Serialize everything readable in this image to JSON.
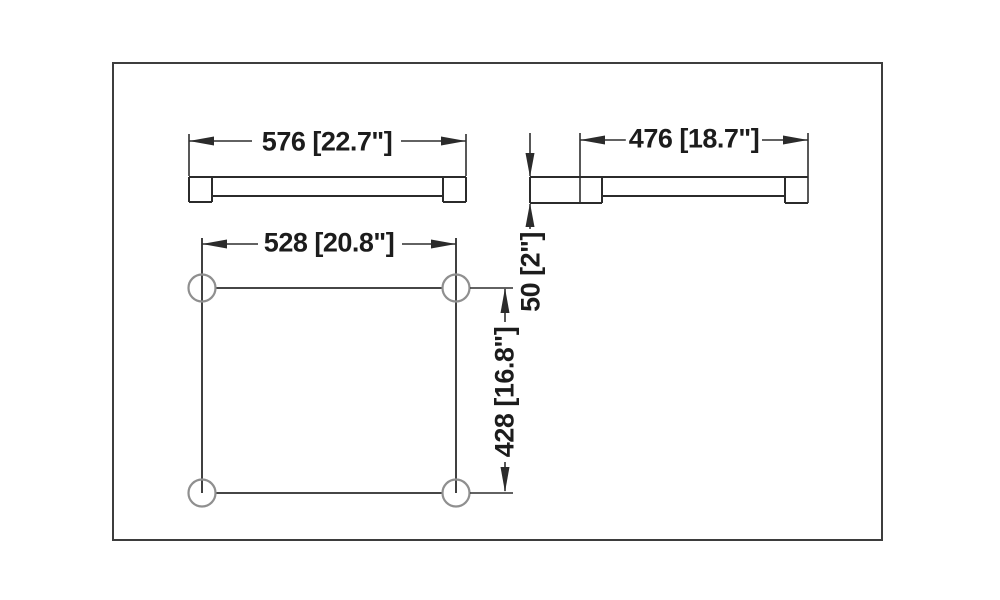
{
  "drawing": {
    "type": "technical-dimension-drawing",
    "front_view": {
      "width_label": "576 [22.7\"]"
    },
    "side_view": {
      "length_label": "476 [18.7\"]",
      "height_label": "50 [2\"]"
    },
    "hole_pattern": {
      "width_label": "528 [20.8\"]",
      "height_label": "428 [16.8\"]"
    },
    "colors": {
      "object_line": "#2b2b2b",
      "dimension_line": "#2e2e2e",
      "circle_line": "#8f8f8f",
      "border": "#3d3d3d",
      "text": "#1c1c1c",
      "background": "#ffffff"
    }
  }
}
